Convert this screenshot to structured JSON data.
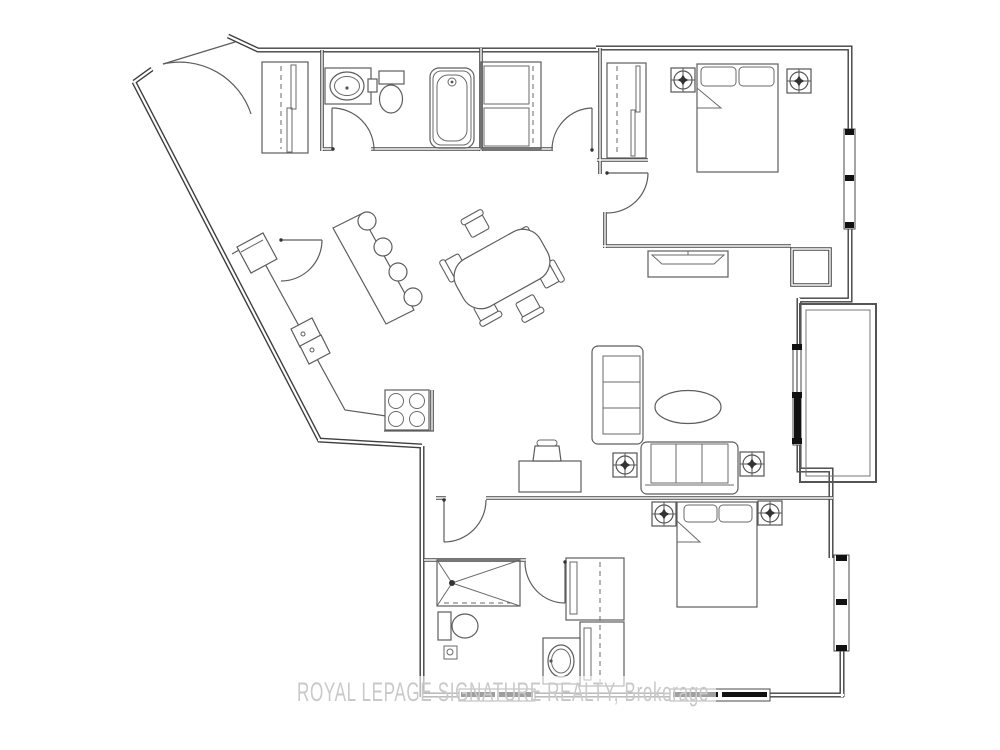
{
  "watermark": {
    "text": "ROYAL LEPAGE SIGNATURE REALTY, Brokerage"
  },
  "colors": {
    "background": "#ffffff",
    "wall_line": "#3f3f3f",
    "furniture_line": "#5d5d5d",
    "window_glazing": "#111111",
    "watermark_text": "#c9c9c9"
  },
  "plan": {
    "kind": "condo-apartment-floor-plan",
    "bedrooms": 2,
    "bathrooms": 2,
    "rooms": [
      {
        "name": "foyer",
        "features": [
          "entry-door",
          "double-door-closet"
        ]
      },
      {
        "name": "main-bathroom",
        "features": [
          "vanity-sink",
          "toilet",
          "bathtub",
          "swing-door"
        ]
      },
      {
        "name": "laundry-closet",
        "features": [
          "stacked-washer-dryer",
          "bifold-doors"
        ]
      },
      {
        "name": "hallway",
        "features": [
          "swing-door"
        ]
      },
      {
        "name": "bedroom-1",
        "features": [
          "double-bed",
          "sliding-door-closet",
          "ceiling-light",
          "ceiling-light",
          "window",
          "tv-console"
        ]
      },
      {
        "name": "kitchen",
        "features": [
          "fridge",
          "pantry-door",
          "counter",
          "double-sink",
          "cooktop-4-burner",
          "island",
          "bar-stool",
          "bar-stool",
          "bar-stool",
          "bar-stool"
        ]
      },
      {
        "name": "dining-area",
        "features": [
          "dining-table",
          "chair",
          "chair",
          "chair",
          "chair",
          "chair",
          "chair"
        ]
      },
      {
        "name": "living-room",
        "features": [
          "loveseat",
          "sofa",
          "coffee-table",
          "desk",
          "desk-chair",
          "ceiling-light",
          "ceiling-light",
          "sliding-balcony-door"
        ]
      },
      {
        "name": "balcony",
        "features": [
          "railing"
        ]
      },
      {
        "name": "bedroom-2",
        "features": [
          "double-bed",
          "wardrobe-closet",
          "ceiling-light",
          "ceiling-light",
          "window",
          "window"
        ]
      },
      {
        "name": "second-bathroom",
        "features": [
          "glass-shower",
          "toilet",
          "vanity-sink",
          "swing-door"
        ]
      }
    ],
    "ceiling_light_count": 6,
    "window_count": 5
  }
}
